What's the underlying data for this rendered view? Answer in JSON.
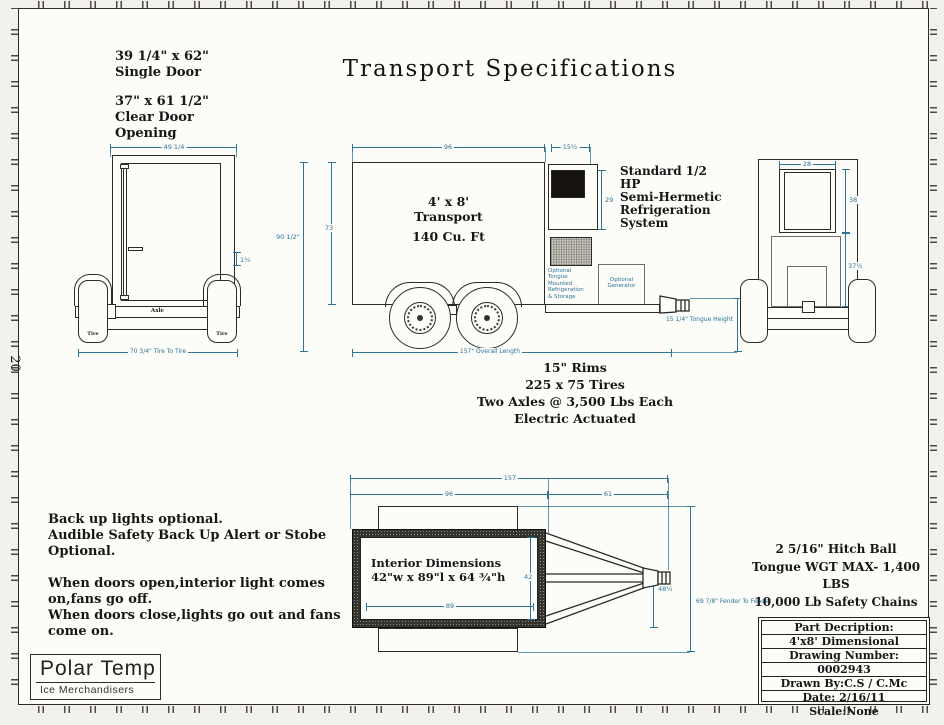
{
  "colors": {
    "dim_blue": "#2d7496",
    "line": "#2b2a27",
    "paper": "#fcfcf9"
  },
  "sheet": {
    "title": "Transport  Specifications",
    "zone_label": "20"
  },
  "door_note": {
    "size": "39 1/4\" x 62\"",
    "size_label": "Single Door",
    "clear_size": "37\" x 61 1/2\"",
    "clear_label1": "Clear Door",
    "clear_label2": "Opening"
  },
  "front_view": {
    "dim_width": "49 1/4",
    "dim_side": "1¾",
    "dim_tire_to_tire": "70 3/4\" Tire To Tire",
    "axle_label": "Axle",
    "tire_label_left": "Tire",
    "tire_label_right": "Tire"
  },
  "side_view": {
    "dim_body_length": "96",
    "dim_condenser_width": "15½",
    "dim_box_height": "73",
    "dim_overall_height": "90 1/2\"",
    "dim_condenser_height": "29",
    "label_size": "4' x 8'",
    "label_name": "Transport",
    "label_capacity": "140 Cu. Ft",
    "storage_label_lines": [
      "Optional",
      "Tongue",
      "Mounted",
      "Refrigeration",
      "& Storage"
    ],
    "generator_label_lines": [
      "Optional",
      "Generator"
    ],
    "dim_tongue_height": "15 1/4\" Tongue Height",
    "dim_overall_length": "157\" Overall Length"
  },
  "refrigeration_note": {
    "lines": [
      "Standard 1/2",
      "HP",
      "Semi-Hermetic",
      "Refrigeration",
      "System"
    ]
  },
  "rear_view": {
    "dim_opening_width": "28",
    "dim_opening_height": "38",
    "dim_lower_height": "37½"
  },
  "axle_specs": {
    "lines": [
      "15\" Rims",
      "225 x 75 Tires",
      "Two Axles @ 3,500 Lbs Each",
      "Electric Actuated"
    ]
  },
  "options_note": {
    "para1": [
      "Back up lights optional.",
      "Audible Safety Back Up Alert or Stobe",
      "Optional."
    ],
    "para2": [
      "When doors open,interior light comes",
      "on,fans go off.",
      "When doors close,lights go out and fans",
      "come on."
    ]
  },
  "top_view": {
    "dim_overall": "157",
    "dim_body": "96",
    "dim_tongue": "61",
    "dim_interior_width": "42",
    "dim_interior_length": "89",
    "dim_tongue_width": "48¼",
    "dim_fender": "69 7/8\" Fender To Fender",
    "interior_title": "Interior Dimensions",
    "interior_dims": "42\"w x 89\"l x 64 ¾\"h"
  },
  "hitch_note": {
    "lines": [
      "2 5/16\" Hitch Ball",
      "Tongue WGT MAX- 1,400 LBS",
      "10,000 Lb Safety Chains"
    ]
  },
  "title_block": {
    "rows": [
      "Part Decription:",
      "4'x8' Dimensional",
      "Drawing Number:",
      "0002943",
      "Drawn By:C.S / C.Mc",
      "Date: 2/16/11",
      "Scale:None"
    ]
  },
  "logo": {
    "name": "Polar Temp",
    "tagline": "Ice Merchandisers"
  }
}
